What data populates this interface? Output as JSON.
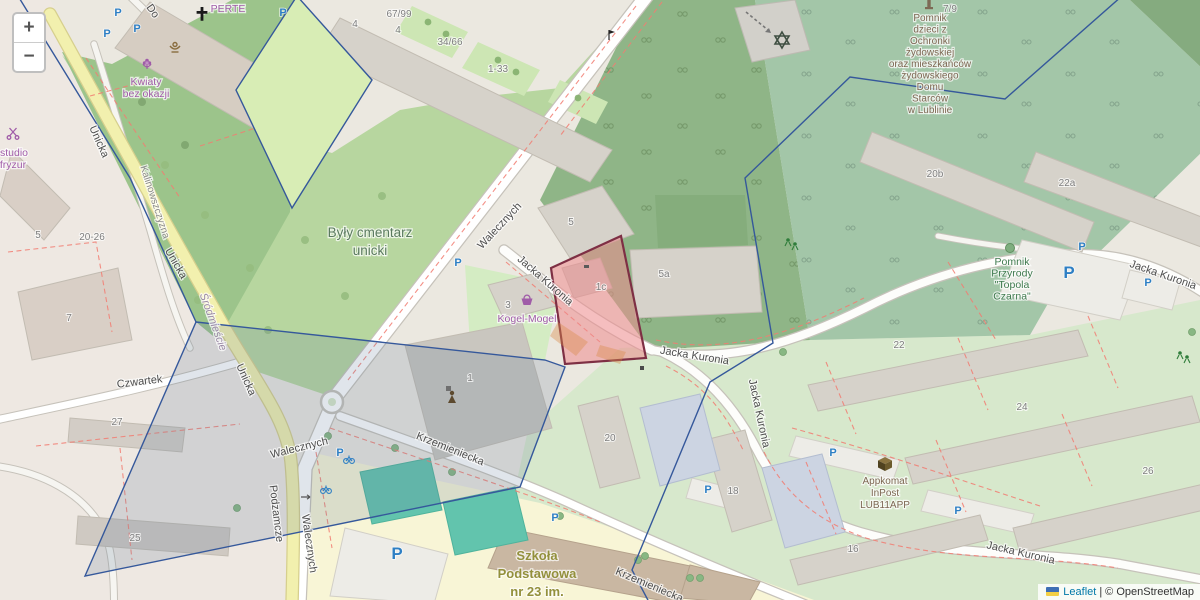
{
  "controls": {
    "zoom_in": "+",
    "zoom_out": "−"
  },
  "attribution": {
    "leaflet": "Leaflet",
    "sep": "|",
    "copyright": "© OpenStreetMap"
  },
  "icons": {
    "parking": "P"
  },
  "streets": {
    "walecznych": "Walecznych",
    "jacka_kuronia": "Jacka Kuronia",
    "unicka": "Unicka",
    "krzemieniecka": "Krzemieniecka",
    "podzamcze": "Podzamcze",
    "czwartek": "Czwartek",
    "kalinowszczyzna": "Kalinowszczyzna",
    "srodmiescie": "Śródmieście",
    "dolna_partial": "Do"
  },
  "places": {
    "cemetery_line1": "Były cmentarz",
    "cemetery_line2": "unicki",
    "memorial_lines": [
      "Pomnik",
      "dzieci z",
      "Ochronki",
      "żydowskiej",
      "oraz mieszkańców",
      "żydowskiego",
      "Domu",
      "Starców",
      "w Lublinie"
    ],
    "poplar_lines": [
      "Pomnik",
      "Przyrody",
      "\"Topola",
      "Czarna\""
    ],
    "school_lines": [
      "Szkoła",
      "Podstawowa",
      "nr 23 im."
    ],
    "inpost_lines": [
      "Appkomat",
      "InPost",
      "LUB11APP"
    ],
    "kogel": "Kogel-Mogel",
    "kwiaty_line1": "Kwiaty",
    "kwiaty_line2": "bez okazji",
    "perte": "PERTE",
    "studio_line1": "studio",
    "studio_line2": "fryzur"
  },
  "house_numbers": {
    "n5l": "5",
    "n7": "7",
    "n2026": "20-26",
    "n25": "25",
    "n27": "27",
    "n5": "5",
    "n5a": "5a",
    "n1c": "1c",
    "n3": "3",
    "n1": "1",
    "n20": "20",
    "n18": "18",
    "n16": "16",
    "n22": "22",
    "n24": "24",
    "n26": "26",
    "n20b": "20b",
    "n22a": "22a",
    "n79": "7/9",
    "n6799": "67/99",
    "n3466": "34/66",
    "n133": "1-33",
    "n4a": "4",
    "n4b": "4"
  },
  "colors": {
    "selection_fill": "#ee8a8e",
    "selection_stroke": "#7e2f44",
    "overlay_stroke": "#35589b",
    "road_main_fill": "#f2f0ae",
    "parking_blue": "#2e7fc4",
    "poi_purple": "#a05ca8",
    "label_brown": "#7d6752",
    "cemetery_green": "#b7d69f",
    "memorial_green": "#a3c6a8"
  }
}
